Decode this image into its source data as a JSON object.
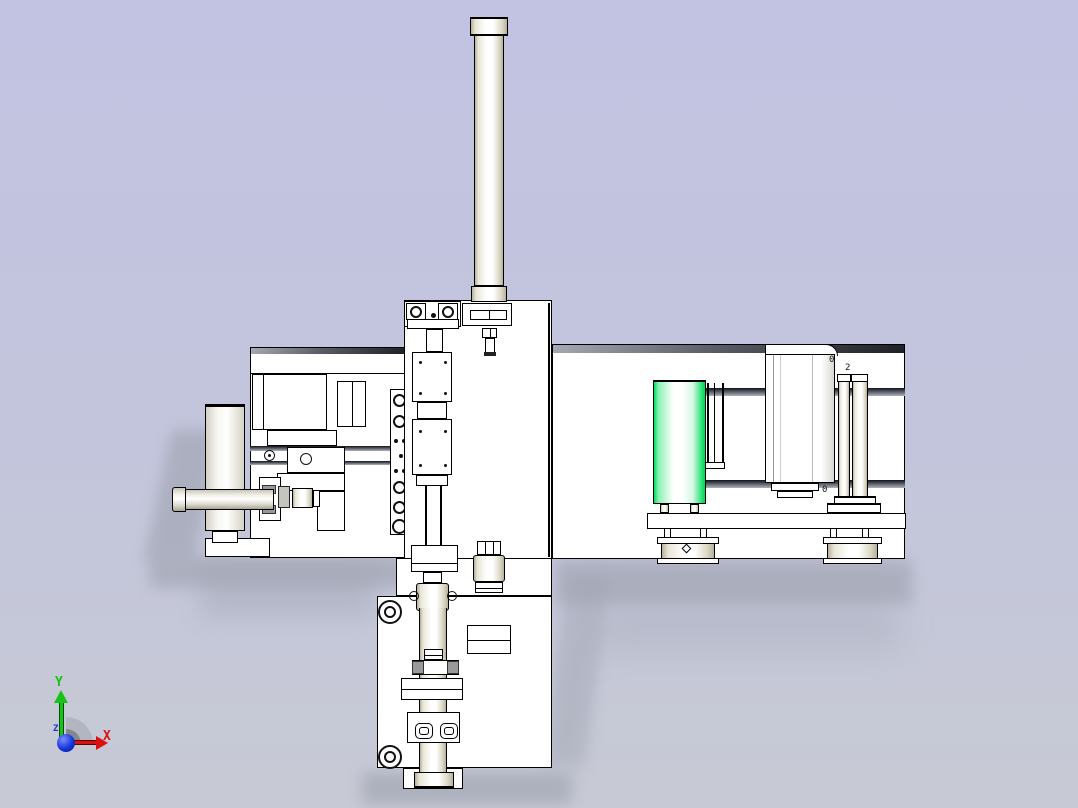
{
  "viewport": {
    "background_top": "#c2c3e2",
    "background_mid": "#c3c5dc",
    "background_bot": "#c7cad4"
  },
  "orientation_triad": {
    "x_label": "X",
    "y_label": "Y",
    "z_label": "Z",
    "x_color": "#dd1010",
    "y_color": "#17c317",
    "z_color": "#2233cc",
    "origin_color": "#1536d8"
  },
  "model": {
    "edge_color": "#000000",
    "face_color": "#ffffff",
    "highlight_color": "#00dc5c",
    "metal_tint": "#d6d2c0",
    "annotations": [
      {
        "id": "roller-top-mark",
        "text": "0"
      },
      {
        "id": "post-top-mark",
        "text": "2"
      },
      {
        "id": "post-bottom-mark",
        "text": "0"
      }
    ]
  }
}
